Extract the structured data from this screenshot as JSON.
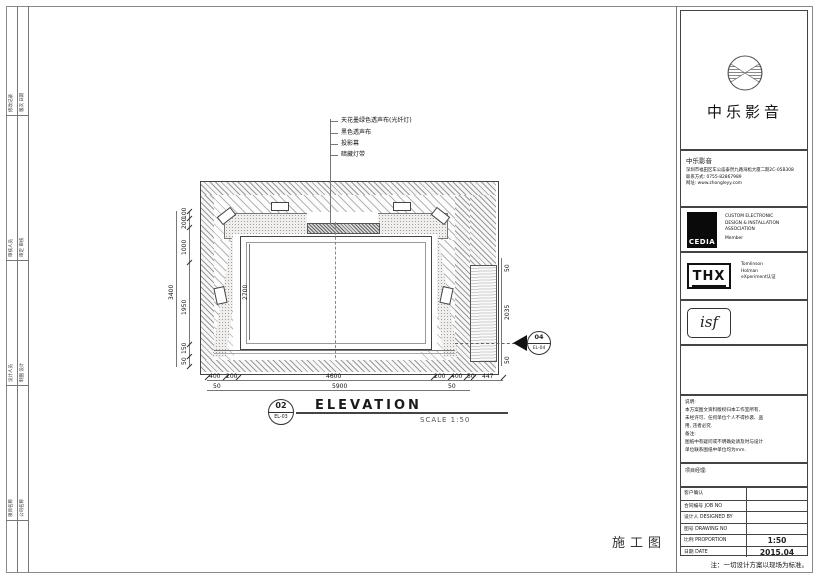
{
  "sheet": {
    "left_strip": {
      "cells": [
        {
          "c1": "修改记录",
          "c2": "版次 日期"
        },
        {
          "c1": "审核人员",
          "c2": "审定 审核"
        },
        {
          "c1": "设计人员",
          "c2": "制图 设计"
        },
        {
          "c1": "项目名称",
          "c2": "公司名称"
        }
      ]
    },
    "drawing": {
      "callouts": [
        "天花墨绿色透声布(光纤灯)",
        "黑色透声布",
        "投影幕",
        "暗藏灯带"
      ],
      "dims": {
        "left_total": "3400",
        "left_chain": [
          "100",
          "200",
          "1000",
          "1950",
          "150",
          "50"
        ],
        "screen_height": "2700",
        "right_chain": [
          "50",
          "2035",
          "50"
        ],
        "bottom_chain": [
          "400",
          "200",
          "4600",
          "200",
          "400",
          "50",
          "447"
        ],
        "bottom_total": [
          "50",
          "5900",
          "50"
        ]
      },
      "section_marker": {
        "number": "04",
        "sheet": "EL-04"
      },
      "title": {
        "number": "02",
        "sheet": "EL-03",
        "label": "ELEVATION",
        "scale": "SCALE  1:50"
      },
      "stamp": "施工图"
    },
    "title_block": {
      "brand": "中乐影音",
      "contact": {
        "company": "中乐影音",
        "address": "深圳市福田区车公庙泰然九路海松大厦二期2C-05B308",
        "phone": "联系方式: 0755-82867989",
        "web": "网址: www.zhongleyy.com"
      },
      "cedia": {
        "logo": "CEDIA",
        "lines": [
          "CUSTOM ELECTRONIC",
          "DESIGN & INSTALLATION",
          "ASSOCIATION",
          "Member"
        ]
      },
      "thx": {
        "logo": "THX",
        "lines": [
          "Tomlinson",
          "Holman",
          "eXperiment认证"
        ]
      },
      "isf": {
        "logo": "isf"
      },
      "notes": {
        "l1": "说明:",
        "l2": "本方案图文资料版权归本工作室所有,",
        "l3": "未经许可、任何单位个人不得抄袭、盗",
        "l4": "用, 违者必究.",
        "l5": "备注:",
        "l6": "图纸中有疑问或不明确处请及时与设计",
        "l7": "单位联系图纸中单位均为mm."
      },
      "pm_label": "项目经理:",
      "rows": [
        {
          "label": "客户确认",
          "value": ""
        },
        {
          "label": "合同编号  JOB NO",
          "value": ""
        },
        {
          "label": "设计人  DESIGNED BY",
          "value": ""
        },
        {
          "label": "图号  DRAWING NO",
          "value": ""
        },
        {
          "label": "比例  PROPORTION",
          "value": "1:50"
        },
        {
          "label": "日期  DATE",
          "value": "2015.04"
        }
      ],
      "footer_note": "注：一切设计方案以现场为标准。"
    }
  }
}
